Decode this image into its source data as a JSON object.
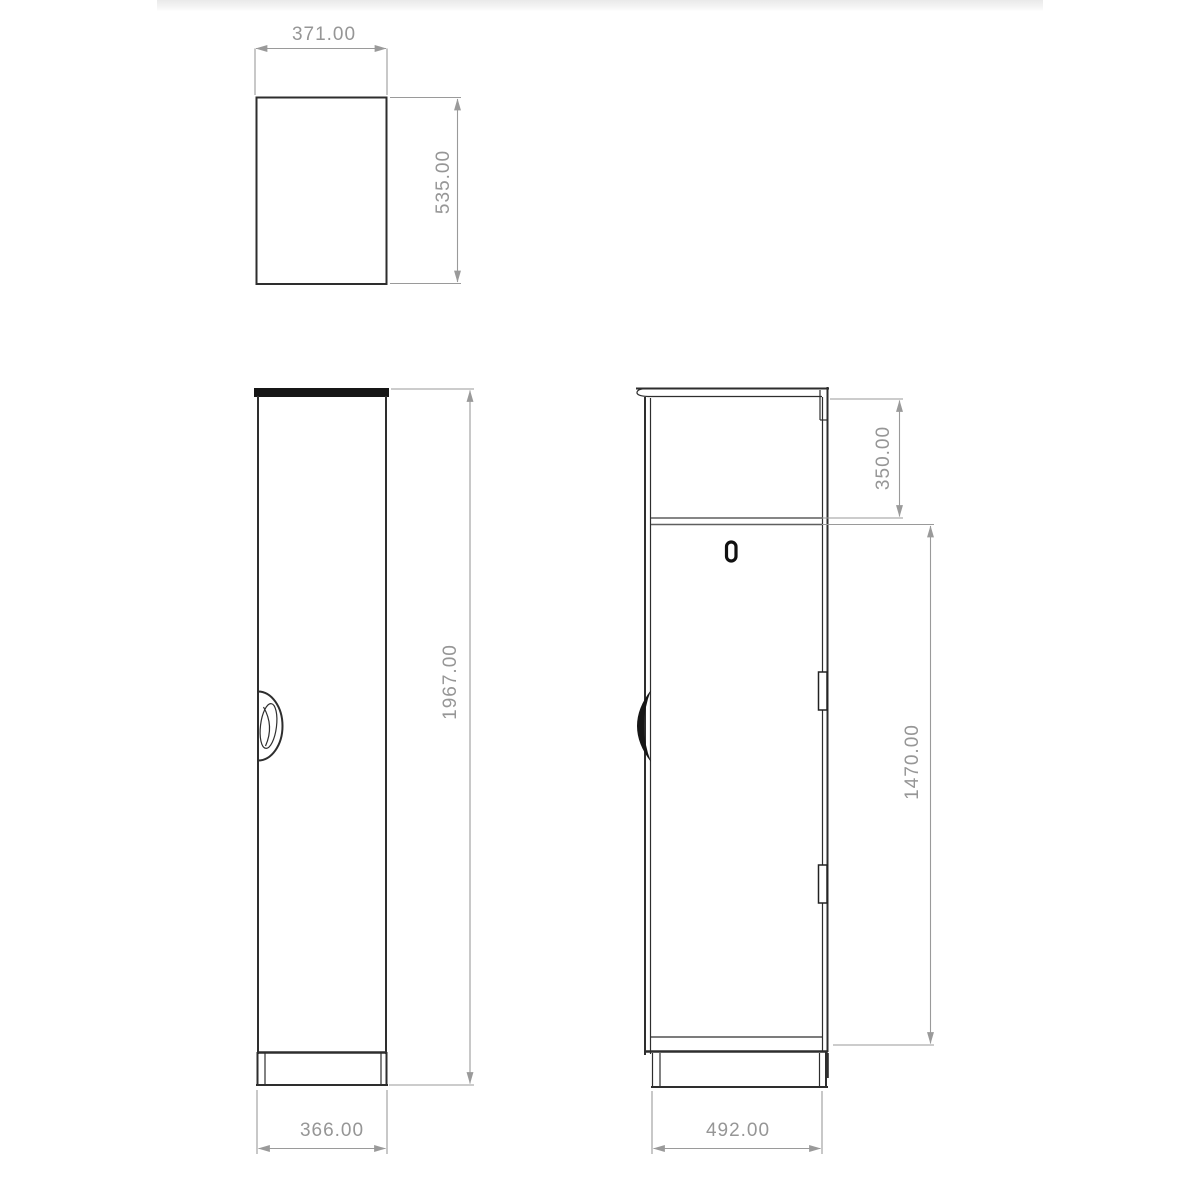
{
  "views": {
    "top_view": {
      "width_mm": "371.00",
      "depth_mm": "535.00"
    },
    "front_view": {
      "height_mm": "1967.00",
      "width_mm": "366.00"
    },
    "side_view": {
      "upper_section_mm": "350.00",
      "door_height_mm": "1470.00",
      "depth_mm": "492.00"
    }
  },
  "colors": {
    "outline": "#2e2e2e",
    "dimension_line": "#9a9a9a",
    "dimension_text": "#969696",
    "background": "#ffffff",
    "top_band": "#e9e9e9"
  }
}
